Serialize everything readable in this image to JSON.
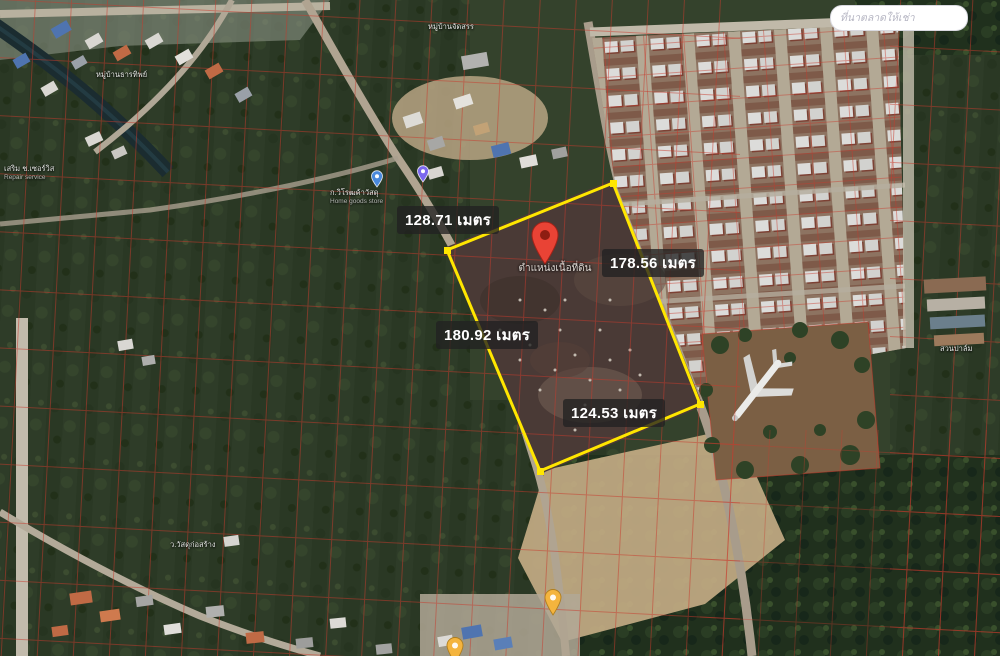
{
  "map": {
    "watermark": "ที่นาตลาดให้เช่า",
    "measurements": {
      "top": "128.71 เมตร",
      "right": "178.56 เมตร",
      "left": "180.92 เมตร",
      "bottom": "124.53 เมตร"
    },
    "plot_label": "ตำแหน่งเนื้อที่ดิน",
    "pois": [
      {
        "label": "หมู่บ้านธารทิพย์",
        "sublabel": ""
      },
      {
        "label": "หมู่บ้านจัดสรร",
        "sublabel": ""
      },
      {
        "label": "ก.วิโรฒค้าวัสดุ",
        "sublabel": "Home goods store"
      },
      {
        "label": "เสริม ช.เซอร์วิส",
        "sublabel": "Repair service"
      },
      {
        "label": "สวนปาล์ม",
        "sublabel": ""
      },
      {
        "label": "ว.วัสดุก่อสร้าง",
        "sublabel": ""
      }
    ],
    "colors": {
      "plot_outline": "#ffe600",
      "pin_red": "#e94335",
      "pin_yellow": "#f4b43e",
      "pin_blue": "#4a89dc",
      "parcel_line": "#c23b2e",
      "label_bg": "rgba(33,33,33,0.78)"
    }
  }
}
